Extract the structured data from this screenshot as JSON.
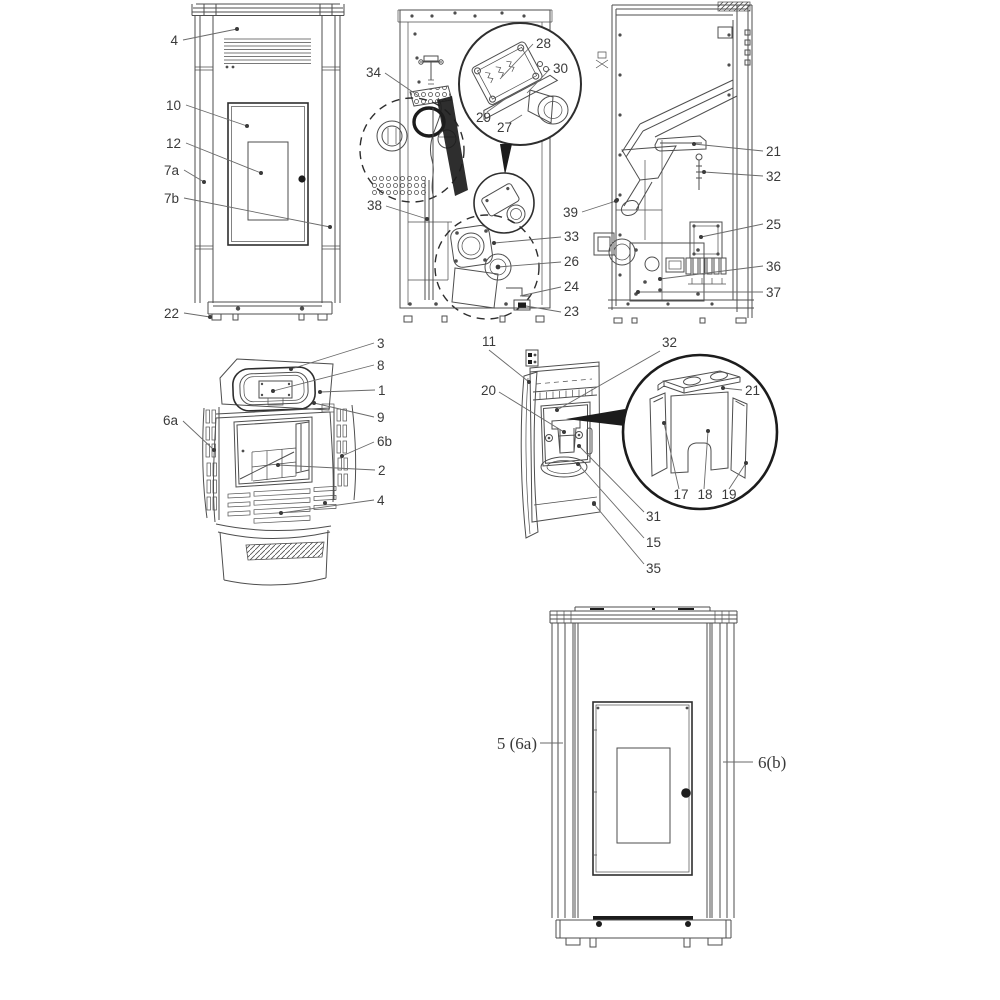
{
  "colors": {
    "line": "#4e4e4e",
    "line-strong": "#2e2e2e",
    "fill-black": "#1c1c1c",
    "label": "#3a3a3a",
    "bg": "#ffffff"
  },
  "views": [
    {
      "name": "front-view-upper",
      "callouts": [
        "4",
        "10",
        "12",
        "7a",
        "7b",
        "22"
      ]
    },
    {
      "name": "rear-section-view",
      "callouts": [
        "34",
        "28",
        "30",
        "29",
        "27",
        "38",
        "39",
        "33",
        "26",
        "24",
        "23"
      ]
    },
    {
      "name": "side-section-view",
      "callouts": [
        "21",
        "32",
        "25",
        "36",
        "37"
      ]
    },
    {
      "name": "top-rear-perspective-view",
      "callouts": [
        "3",
        "8",
        "1",
        "9",
        "6a",
        "6b",
        "2",
        "4"
      ]
    },
    {
      "name": "firebox-detail-view",
      "callouts": [
        "11",
        "32",
        "20",
        "21",
        "17",
        "18",
        "19",
        "31",
        "15",
        "35"
      ]
    },
    {
      "name": "front-view-lower",
      "callouts": [
        "5 (6a)",
        "6(b)"
      ]
    }
  ]
}
